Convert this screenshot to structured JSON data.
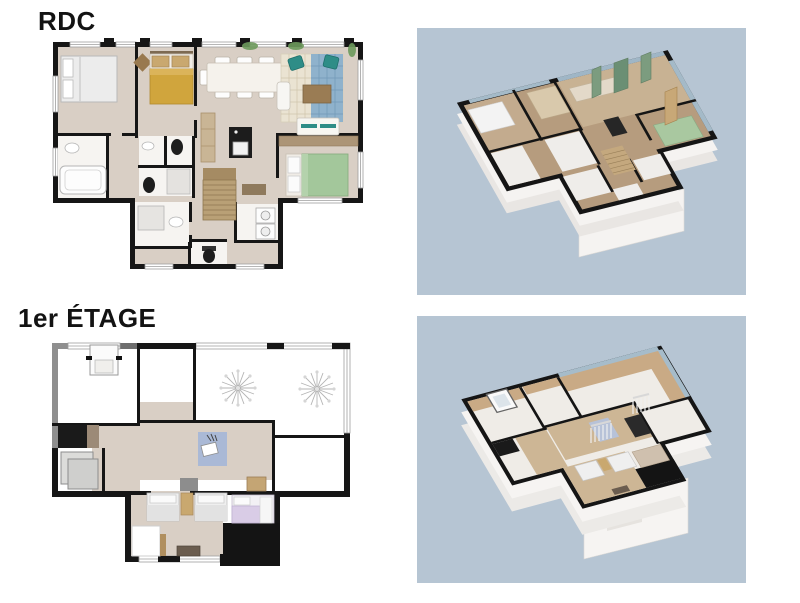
{
  "page": {
    "background": "#ffffff",
    "type": "floorplan-presentation"
  },
  "floors": [
    {
      "id": "rdc",
      "label": "RDC",
      "plan2d": {
        "wall_color": "#161616",
        "floor_color": "#d9cfc5",
        "bath_floor_color": "#f6f4f1",
        "symbols": [
          "double-bed-white",
          "double-bed-mustard",
          "double-bed-green",
          "dining-table-8-chairs",
          "area-rug-blue-pattern",
          "armchair-teal",
          "armchair-teal",
          "sofa-white",
          "chaise-white",
          "coffee-table-wood",
          "kitchen-island-black",
          "tall-cabinet",
          "bathtub",
          "shower",
          "toilet",
          "toilet",
          "washing-machine",
          "washing-machine",
          "staircase",
          "diamond-rug",
          "plants"
        ]
      },
      "render3d": {
        "background": "#b6c5d3",
        "view": "isometric-dollhouse",
        "floor_color": "#b69c7e",
        "wall_top_color": "#151515",
        "exterior_wall_color": "#f5f3f1",
        "accents": [
          "green-wall-panels",
          "window-glass-blue"
        ]
      }
    },
    {
      "id": "etage1",
      "label": "1er ÉTAGE",
      "plan2d": {
        "wall_color": "#161616",
        "gray_wall_color": "#8f8f8f",
        "floor_color": "#d9cfc5",
        "open_floor_color": "#ffffff",
        "symbols": [
          "skylight-window",
          "ceiling-light-starburst",
          "ceiling-light-starburst",
          "desk-with-chair",
          "area-rug-blue",
          "single-bed-white",
          "single-bed-white",
          "nightstand-wood",
          "single-bed-lilac",
          "dresser-dark",
          "closet-white",
          "storage-mats-gray",
          "bench-wood"
        ]
      },
      "render3d": {
        "background": "#b6c5d3",
        "view": "isometric-dollhouse",
        "floor_color": "#efece7",
        "sloped_ceiling_color": "#c9aa85",
        "wall_top_color": "#151515",
        "exterior_wall_color": "#f6f4f2",
        "accents": [
          "stair-railing",
          "skylight-box",
          "window-glass-blue",
          "roof-terrace-black"
        ]
      }
    }
  ]
}
